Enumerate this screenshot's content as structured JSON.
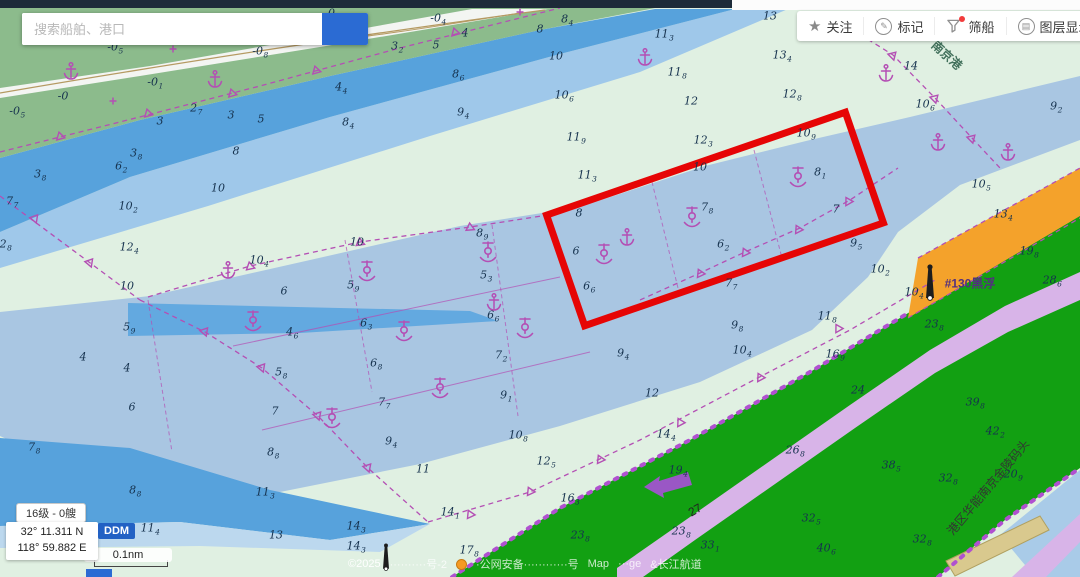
{
  "ui": {
    "search": {
      "placeholder": "搜索船舶、港口"
    },
    "toolbar": {
      "items": [
        {
          "label": "关注",
          "icon": "star-icon"
        },
        {
          "label": "标记",
          "icon": "pencil-circle-icon"
        },
        {
          "label": "筛船",
          "icon": "funnel-icon",
          "has_badge": true
        },
        {
          "label": "图层显示",
          "icon": "layers-circle-icon"
        },
        {
          "label": "",
          "icon": "partial-circle-icon"
        }
      ]
    },
    "status": {
      "zoom_ships": "16级 - 0艘",
      "lat": "32° 11.311 N",
      "lon": "118° 59.882 E",
      "coord_format": "DDM",
      "scale_label": "0.1nm"
    },
    "footer": {
      "copyright": "©2025",
      "frag_icp": "··········号-2",
      "frag_gongan": "·公网安备············号",
      "frag_map": "Map",
      "frag_ge": "···ge",
      "frag_channel": "&长江航道"
    }
  },
  "colors": {
    "base_flat": "#e0f0e2",
    "land_green": "#8cbb8c",
    "river_white": "#f3f5f2",
    "contour_tan": "#b59a62",
    "water_deepest": "#57a2dc",
    "water_deep": "#9fc8ea",
    "channel_blue": "#a9c6e2",
    "pocket_blue": "#63a9e0",
    "under_band": "#bcd8ee",
    "zone_green": "#12a012",
    "road_lavender": "#d8b4e8",
    "terminal_orange": "#f4a22b",
    "pier_tan": "#d9c98e",
    "magenta": "#b44fb4",
    "magenta_dots": "#b050d0",
    "red_box": "#e60505",
    "sounding": "#16324e",
    "arrow_purple": "#9a57c5",
    "corner_blue": "#a9cbe8"
  },
  "chart": {
    "red_box": {
      "cx": 715,
      "cy": 219,
      "w": 316,
      "h": 117,
      "rot": -19
    },
    "labels": [
      {
        "text": "#130黑浮",
        "x": 970,
        "y": 283,
        "rot": 0,
        "size": 12,
        "color": "#53307e",
        "bold": true
      },
      {
        "text": "南京港",
        "x": 947,
        "y": 55,
        "rot": 42,
        "size": 12,
        "color": "#41705b",
        "bold": true
      },
      {
        "text": "港区华能南京金陵码头",
        "x": 988,
        "y": 487,
        "rot": -50,
        "size": 12,
        "color": "#333333",
        "bold": false
      },
      {
        "text": "27",
        "x": 695,
        "y": 510,
        "rot": -30,
        "size": 12,
        "color": "#222222",
        "bold": false
      }
    ],
    "soundings": [
      [
        115,
        47,
        "-0",
        "5"
      ],
      [
        260,
        51,
        "-0",
        "8"
      ],
      [
        63,
        96,
        "-0",
        ""
      ],
      [
        155,
        82,
        "-0",
        "1"
      ],
      [
        17,
        111,
        "-0",
        "5"
      ],
      [
        438,
        18,
        "-0",
        "4"
      ],
      [
        332,
        13,
        "-0",
        "8"
      ],
      [
        160,
        121,
        "3",
        ""
      ],
      [
        196,
        108,
        "2",
        "7"
      ],
      [
        231,
        115,
        "3",
        ""
      ],
      [
        261,
        119,
        "5",
        ""
      ],
      [
        341,
        87,
        "4",
        "4"
      ],
      [
        348,
        122,
        "8",
        "4"
      ],
      [
        136,
        153,
        "3",
        "8"
      ],
      [
        121,
        166,
        "6",
        "2"
      ],
      [
        40,
        174,
        "3",
        "8"
      ],
      [
        236,
        151,
        "8",
        ""
      ],
      [
        218,
        188,
        "10",
        ""
      ],
      [
        397,
        46,
        "3",
        "2"
      ],
      [
        436,
        45,
        "5",
        ""
      ],
      [
        465,
        33,
        "4",
        ""
      ],
      [
        540,
        29,
        "8",
        ""
      ],
      [
        567,
        19,
        "8",
        "4"
      ],
      [
        556,
        56,
        "10",
        ""
      ],
      [
        458,
        74,
        "8",
        "6"
      ],
      [
        463,
        112,
        "9",
        "4"
      ],
      [
        564,
        95,
        "10",
        "6"
      ],
      [
        664,
        34,
        "11",
        "3"
      ],
      [
        677,
        72,
        "11",
        "8"
      ],
      [
        691,
        101,
        "12",
        ""
      ],
      [
        770,
        16,
        "13",
        ""
      ],
      [
        782,
        55,
        "13",
        "4"
      ],
      [
        792,
        94,
        "12",
        "8"
      ],
      [
        911,
        66,
        "14",
        ""
      ],
      [
        925,
        104,
        "10",
        "6"
      ],
      [
        1056,
        106,
        "9",
        "2"
      ],
      [
        12,
        201,
        "7",
        "7"
      ],
      [
        128,
        206,
        "10",
        "2"
      ],
      [
        2,
        244,
        "12",
        "8"
      ],
      [
        129,
        247,
        "12",
        "4"
      ],
      [
        127,
        286,
        "10",
        ""
      ],
      [
        129,
        327,
        "5",
        "9"
      ],
      [
        127,
        368,
        "4",
        ""
      ],
      [
        259,
        260,
        "10",
        "4"
      ],
      [
        284,
        291,
        "6",
        ""
      ],
      [
        353,
        285,
        "5",
        "9"
      ],
      [
        292,
        332,
        "4",
        "6"
      ],
      [
        281,
        372,
        "5",
        "8"
      ],
      [
        366,
        323,
        "6",
        "3"
      ],
      [
        376,
        363,
        "6",
        "8"
      ],
      [
        384,
        402,
        "7",
        "7"
      ],
      [
        275,
        411,
        "7",
        ""
      ],
      [
        273,
        452,
        "8",
        "8"
      ],
      [
        482,
        233,
        "8",
        "9"
      ],
      [
        486,
        275,
        "5",
        "3"
      ],
      [
        493,
        315,
        "6",
        "6"
      ],
      [
        501,
        355,
        "7",
        "2"
      ],
      [
        506,
        395,
        "9",
        "1"
      ],
      [
        357,
        242,
        "10",
        ""
      ],
      [
        576,
        137,
        "11",
        "9"
      ],
      [
        587,
        175,
        "11",
        "3"
      ],
      [
        703,
        140,
        "12",
        "3"
      ],
      [
        700,
        167,
        "10",
        ""
      ],
      [
        806,
        133,
        "10",
        "9"
      ],
      [
        820,
        172,
        "8",
        "1"
      ],
      [
        579,
        213,
        "8",
        ""
      ],
      [
        707,
        207,
        "7",
        "8"
      ],
      [
        836,
        209,
        "7",
        ""
      ],
      [
        576,
        251,
        "6",
        ""
      ],
      [
        723,
        244,
        "6",
        "2"
      ],
      [
        589,
        286,
        "6",
        "6"
      ],
      [
        731,
        283,
        "7",
        "7"
      ],
      [
        856,
        243,
        "9",
        "5"
      ],
      [
        880,
        269,
        "10",
        "2"
      ],
      [
        737,
        325,
        "9",
        "8"
      ],
      [
        827,
        316,
        "11",
        "8"
      ],
      [
        623,
        353,
        "9",
        "4"
      ],
      [
        652,
        393,
        "12",
        ""
      ],
      [
        742,
        350,
        "10",
        "4"
      ],
      [
        518,
        435,
        "10",
        "8"
      ],
      [
        546,
        461,
        "12",
        "5"
      ],
      [
        423,
        469,
        "11",
        ""
      ],
      [
        265,
        492,
        "11",
        "3"
      ],
      [
        276,
        535,
        "13",
        ""
      ],
      [
        356,
        526,
        "14",
        "3"
      ],
      [
        356,
        546,
        "14",
        "3"
      ],
      [
        450,
        512,
        "14",
        "1"
      ],
      [
        391,
        441,
        "9",
        "4"
      ],
      [
        981,
        184,
        "10",
        "5"
      ],
      [
        1003,
        214,
        "13",
        "4"
      ],
      [
        1029,
        251,
        "19",
        "8"
      ],
      [
        1052,
        280,
        "28",
        "6"
      ],
      [
        934,
        324,
        "23",
        "8"
      ],
      [
        914,
        292,
        "10",
        "4"
      ],
      [
        666,
        434,
        "14",
        "4"
      ],
      [
        678,
        470,
        "19",
        "4"
      ],
      [
        570,
        498,
        "16",
        "3"
      ],
      [
        580,
        535,
        "23",
        "8"
      ],
      [
        795,
        450,
        "26",
        "8"
      ],
      [
        835,
        354,
        "16",
        "9"
      ],
      [
        858,
        390,
        "24",
        ""
      ],
      [
        681,
        531,
        "23",
        "8"
      ],
      [
        710,
        545,
        "33",
        "1"
      ],
      [
        811,
        518,
        "32",
        "5"
      ],
      [
        826,
        548,
        "40",
        "6"
      ],
      [
        891,
        465,
        "38",
        "5"
      ],
      [
        922,
        539,
        "32",
        "8"
      ],
      [
        975,
        402,
        "39",
        "8"
      ],
      [
        995,
        431,
        "42",
        "2"
      ],
      [
        948,
        478,
        "32",
        "8"
      ],
      [
        1013,
        474,
        "20",
        "9"
      ],
      [
        132,
        407,
        "6",
        ""
      ],
      [
        83,
        357,
        "4",
        ""
      ],
      [
        34,
        447,
        "7",
        "8"
      ],
      [
        135,
        490,
        "8",
        "8"
      ],
      [
        150,
        528,
        "11",
        "4"
      ],
      [
        469,
        550,
        "17",
        "8"
      ]
    ],
    "anchorage_symbols": [
      [
        253,
        320
      ],
      [
        367,
        270
      ],
      [
        404,
        330
      ],
      [
        440,
        387
      ],
      [
        332,
        417
      ],
      [
        488,
        251
      ],
      [
        525,
        327
      ],
      [
        604,
        253
      ],
      [
        692,
        216
      ],
      [
        798,
        176
      ]
    ],
    "anchor_symbols": [
      [
        627,
        237
      ],
      [
        494,
        302
      ],
      [
        228,
        270
      ],
      [
        938,
        142
      ],
      [
        886,
        73
      ],
      [
        71,
        71
      ],
      [
        215,
        79
      ],
      [
        645,
        57
      ],
      [
        1008,
        152
      ]
    ],
    "cross_symbols": [
      [
        173,
        49
      ],
      [
        113,
        101
      ],
      [
        520,
        12
      ]
    ],
    "triangles": [
      [
        60,
        136,
        -15
      ],
      [
        148,
        113,
        -15
      ],
      [
        232,
        93,
        -16
      ],
      [
        316,
        70,
        -16
      ],
      [
        455,
        32,
        -16
      ],
      [
        205,
        331,
        40
      ],
      [
        262,
        367,
        40
      ],
      [
        318,
        415,
        42
      ],
      [
        368,
        467,
        42
      ],
      [
        470,
        514,
        -25
      ],
      [
        530,
        491,
        -25
      ],
      [
        600,
        459,
        -25
      ],
      [
        680,
        422,
        -28
      ],
      [
        760,
        377,
        -28
      ],
      [
        838,
        328,
        -30
      ],
      [
        700,
        273,
        -25
      ],
      [
        745,
        252,
        -25
      ],
      [
        798,
        229,
        -27
      ],
      [
        848,
        201,
        -30
      ],
      [
        250,
        266,
        -12
      ],
      [
        360,
        242,
        -8
      ],
      [
        470,
        227,
        -5
      ],
      [
        893,
        55,
        45
      ],
      [
        935,
        98,
        45
      ],
      [
        972,
        138,
        45
      ],
      [
        35,
        218,
        40
      ],
      [
        90,
        262,
        40
      ]
    ],
    "dashed_lines": [
      {
        "pts": [
          [
            0,
            152
          ],
          [
            120,
            122
          ],
          [
            260,
            86
          ],
          [
            400,
            48
          ],
          [
            520,
            18
          ],
          [
            560,
            8
          ]
        ]
      },
      {
        "pts": [
          [
            140,
            300
          ],
          [
            205,
            332
          ],
          [
            262,
            368
          ],
          [
            318,
            416
          ],
          [
            368,
            468
          ],
          [
            428,
            522
          ]
        ]
      },
      {
        "pts": [
          [
            428,
            522
          ],
          [
            530,
            492
          ],
          [
            640,
            440
          ],
          [
            750,
            382
          ],
          [
            850,
            330
          ],
          [
            935,
            280
          ]
        ]
      },
      {
        "pts": [
          [
            640,
            300
          ],
          [
            700,
            273
          ],
          [
            745,
            252
          ],
          [
            800,
            228
          ],
          [
            850,
            200
          ],
          [
            898,
            168
          ]
        ]
      },
      {
        "pts": [
          [
            148,
            297
          ],
          [
            250,
            266
          ],
          [
            360,
            242
          ],
          [
            470,
            227
          ],
          [
            548,
            215
          ]
        ]
      },
      {
        "pts": [
          [
            845,
            25
          ],
          [
            893,
            55
          ],
          [
            935,
            98
          ],
          [
            972,
            138
          ],
          [
            1000,
            168
          ]
        ]
      },
      {
        "pts": [
          [
            918,
            258
          ],
          [
            1080,
            168
          ]
        ]
      },
      {
        "pts": [
          [
            908,
            318
          ],
          [
            1080,
            218
          ]
        ]
      },
      {
        "pts": [
          [
            0,
            196
          ],
          [
            70,
            248
          ],
          [
            140,
            300
          ]
        ]
      },
      {
        "pts": [
          [
            452,
            577
          ],
          [
            560,
            508
          ],
          [
            690,
            440
          ],
          [
            810,
            372
          ],
          [
            905,
            315
          ]
        ],
        "cls": "dots"
      },
      {
        "pts": [
          [
            938,
            577
          ],
          [
            1005,
            520
          ],
          [
            1080,
            468
          ]
        ],
        "cls": "dots"
      }
    ],
    "thin_lines": [
      {
        "pts": [
          [
            345,
            240
          ],
          [
            372,
            392
          ]
        ],
        "dash": true
      },
      {
        "pts": [
          [
            492,
            225
          ],
          [
            518,
            416
          ]
        ],
        "dash": true
      },
      {
        "pts": [
          [
            233,
            346
          ],
          [
            560,
            277
          ]
        ],
        "dash": false
      },
      {
        "pts": [
          [
            262,
            430
          ],
          [
            590,
            352
          ]
        ],
        "dash": false
      },
      {
        "pts": [
          [
            652,
            182
          ],
          [
            678,
            288
          ]
        ],
        "dash": true
      },
      {
        "pts": [
          [
            754,
            150
          ],
          [
            782,
            258
          ]
        ],
        "dash": true
      },
      {
        "pts": [
          [
            148,
            300
          ],
          [
            172,
            452
          ]
        ],
        "dash": true
      }
    ],
    "arrow_points": "644,487 660,476 659,481 688,472 692,485 663,493 664,498",
    "beacons": [
      [
        930,
        281,
        1.0
      ],
      [
        386,
        556,
        0.75
      ]
    ]
  }
}
